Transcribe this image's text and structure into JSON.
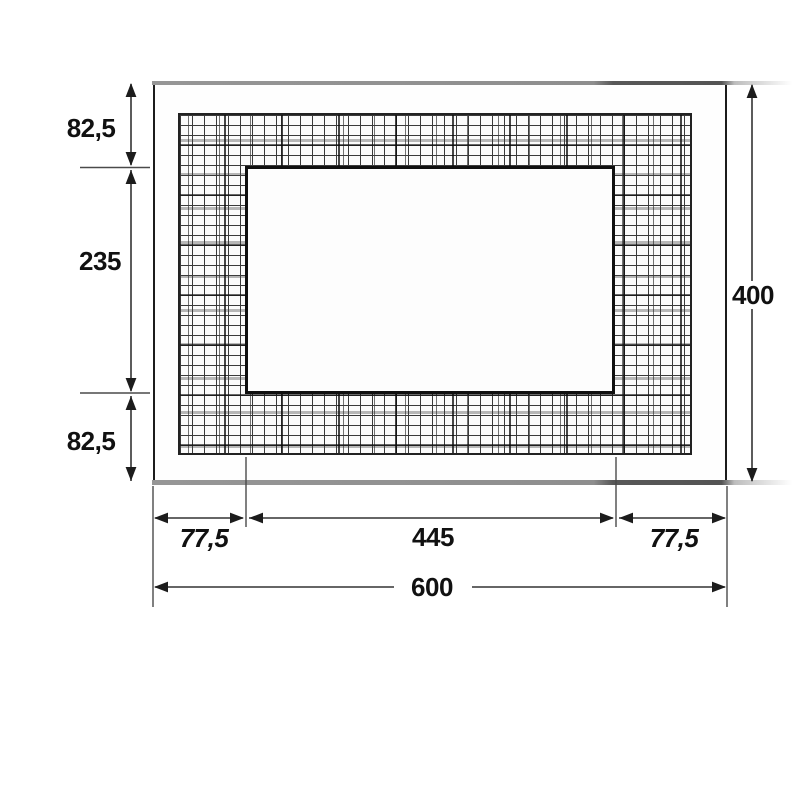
{
  "drawing": {
    "labels": {
      "top_margin": "82,5",
      "cutout_height": "235",
      "bottom_margin": "82,5",
      "total_height": "400",
      "left_margin": "77,5",
      "cutout_width": "445",
      "right_margin": "77,5",
      "total_width": "600"
    },
    "colors": {
      "outline": "#1c1c1c",
      "dimension_line": "#3a3a3a",
      "metal_edge_gray": "#8e8e8e",
      "hatch_dark": "#2e2e2e",
      "hatch_gray": "#ababab",
      "background": "#ffffff"
    }
  }
}
